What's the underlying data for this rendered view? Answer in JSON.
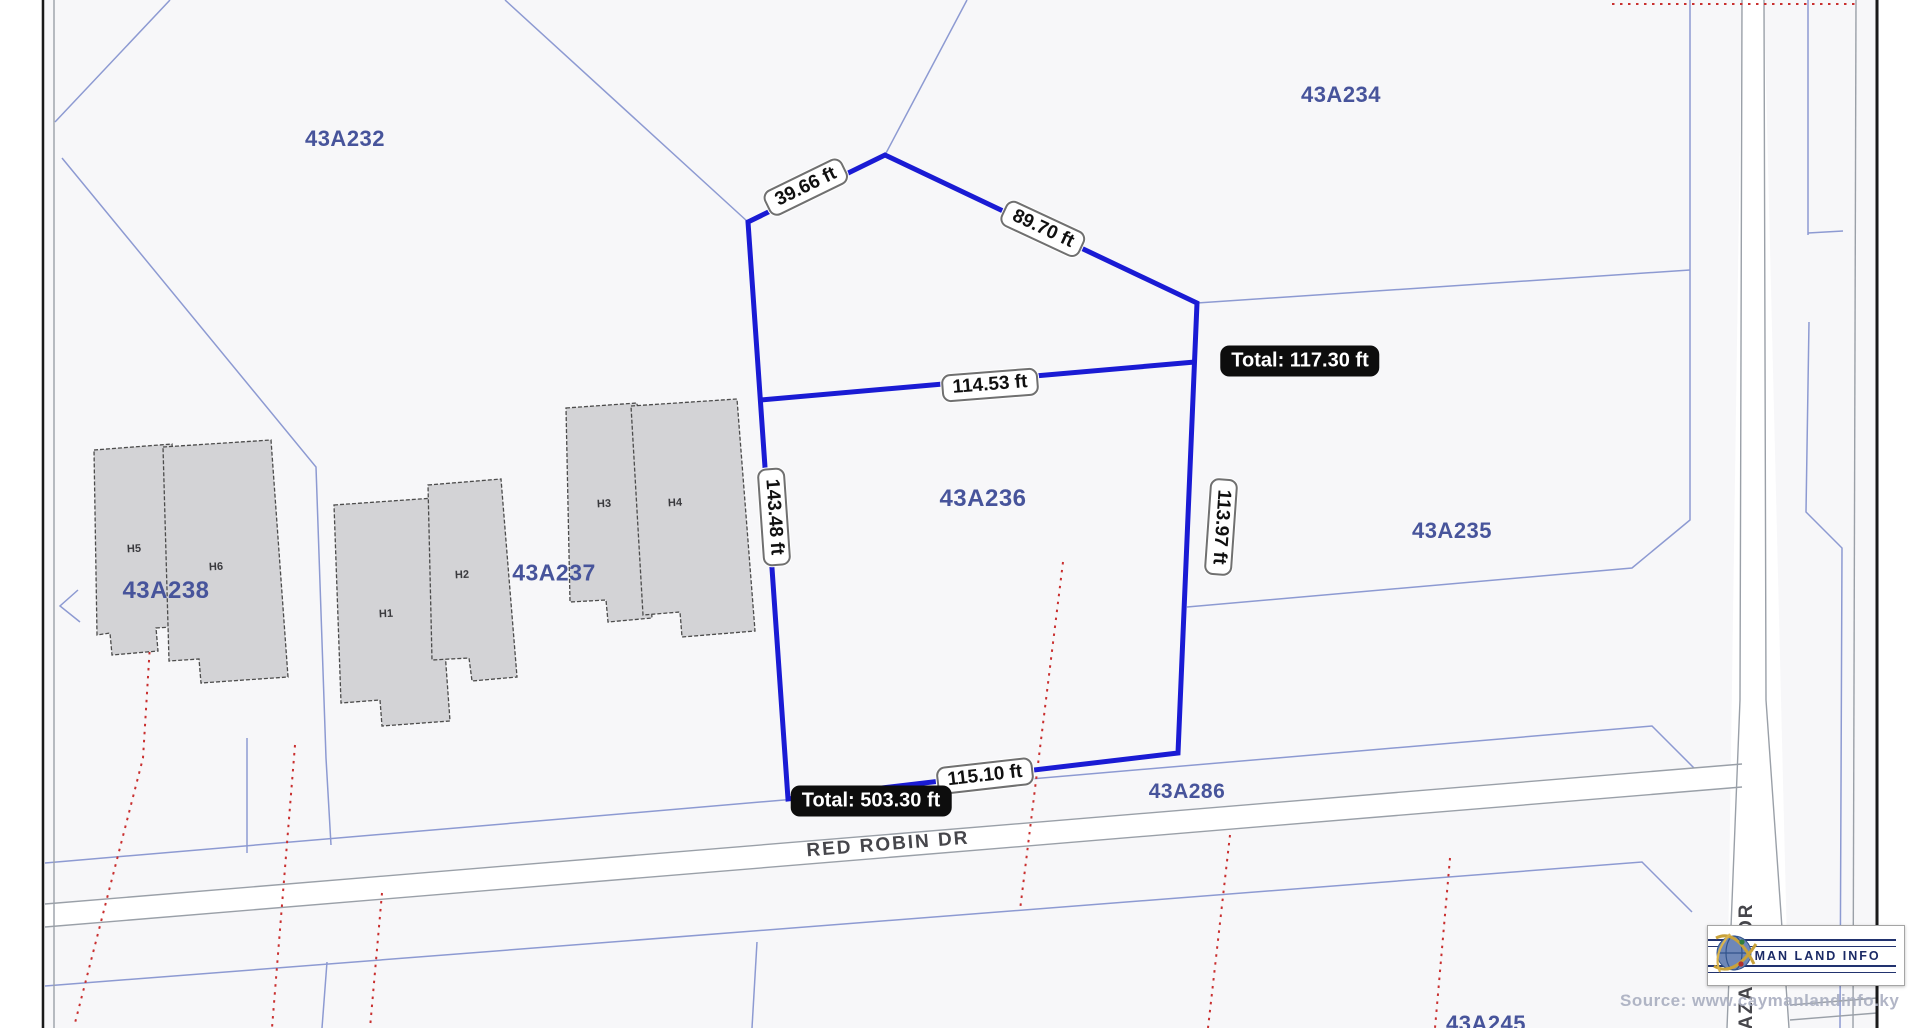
{
  "parcels": [
    {
      "id": "43A232"
    },
    {
      "id": "43A234"
    },
    {
      "id": "43A235"
    },
    {
      "id": "43A236"
    },
    {
      "id": "43A237"
    },
    {
      "id": "43A238"
    },
    {
      "id": "43A286"
    },
    {
      "id": "43A245"
    }
  ],
  "buildings": [
    {
      "id": "H1"
    },
    {
      "id": "H2"
    },
    {
      "id": "H3"
    },
    {
      "id": "H4"
    },
    {
      "id": "H5"
    },
    {
      "id": "H6"
    }
  ],
  "roads": {
    "red_robin": "RED ROBIN DR",
    "azalea": "AZALEA DR"
  },
  "measurements": {
    "segments": [
      {
        "value": "39.66 ft"
      },
      {
        "value": "89.70 ft"
      },
      {
        "value": "114.53 ft"
      },
      {
        "value": "143.48 ft"
      },
      {
        "value": "113.97 ft"
      },
      {
        "value": "115.10 ft"
      }
    ],
    "totals": [
      {
        "value": "Total: 117.30 ft"
      },
      {
        "value": "Total: 503.30 ft"
      }
    ]
  },
  "branding": {
    "logo_text": "CAYMAN LAND INFO",
    "watermark": "Source: www.caymanlandinfo.ky"
  },
  "colors": {
    "measure_line": "#1a1bd4",
    "cadastral_line": "#8d9ad2",
    "parcel_label": "#47549b",
    "total_badge_bg": "#0d0d0d",
    "red_dotted": "#c93030",
    "building_fill": "#d3d3d6"
  }
}
